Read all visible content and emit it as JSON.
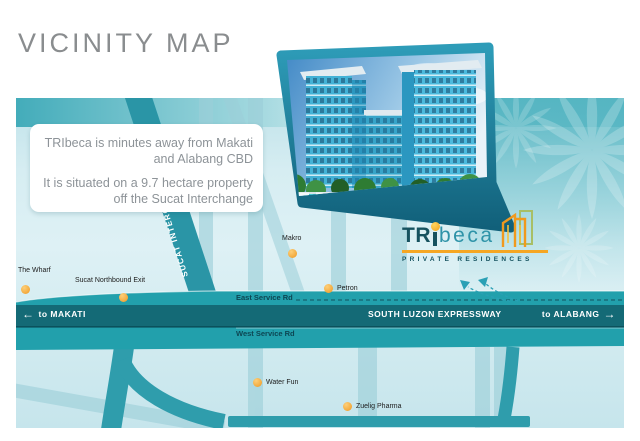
{
  "page": {
    "title": "VICINITY MAP"
  },
  "infobox": {
    "line1": "TRIbeca is minutes away from Makati and Alabang CBD",
    "line2": "It is situated on a 9.7 hectare property off the Sucat Interchange"
  },
  "logo": {
    "tr": "TR",
    "beca": "beca",
    "tagline": "PRIVATE RESIDENCES"
  },
  "map": {
    "roads": {
      "sucat": "SUCAT INTERCHANGE",
      "east_service": "East Service Rd",
      "west_service": "West Service Rd",
      "expressway": "SOUTH LUZON EXPRESSWAY",
      "to_makati": "to MAKATI",
      "to_alabang": "to ALABANG"
    },
    "icons": {
      "arrow_left": "←",
      "arrow_right": "→"
    },
    "pois": [
      {
        "label": "The Wharf"
      },
      {
        "label": "Sucat Northbound Exit"
      },
      {
        "label": "Makro"
      },
      {
        "label": "Petron"
      },
      {
        "label": "Water Fun"
      },
      {
        "label": "Zuelig Pharma"
      }
    ],
    "colors": {
      "expressway_band": "#146a76",
      "service_band": "#22a0ac",
      "light_road": "#9ccfd9",
      "poi_dot": "#f3a93c",
      "accent_teal": "#2aa0b5",
      "logo_dark": "#16525f",
      "logo_teal": "#2e93a8",
      "logo_orange": "#f5a623"
    }
  }
}
